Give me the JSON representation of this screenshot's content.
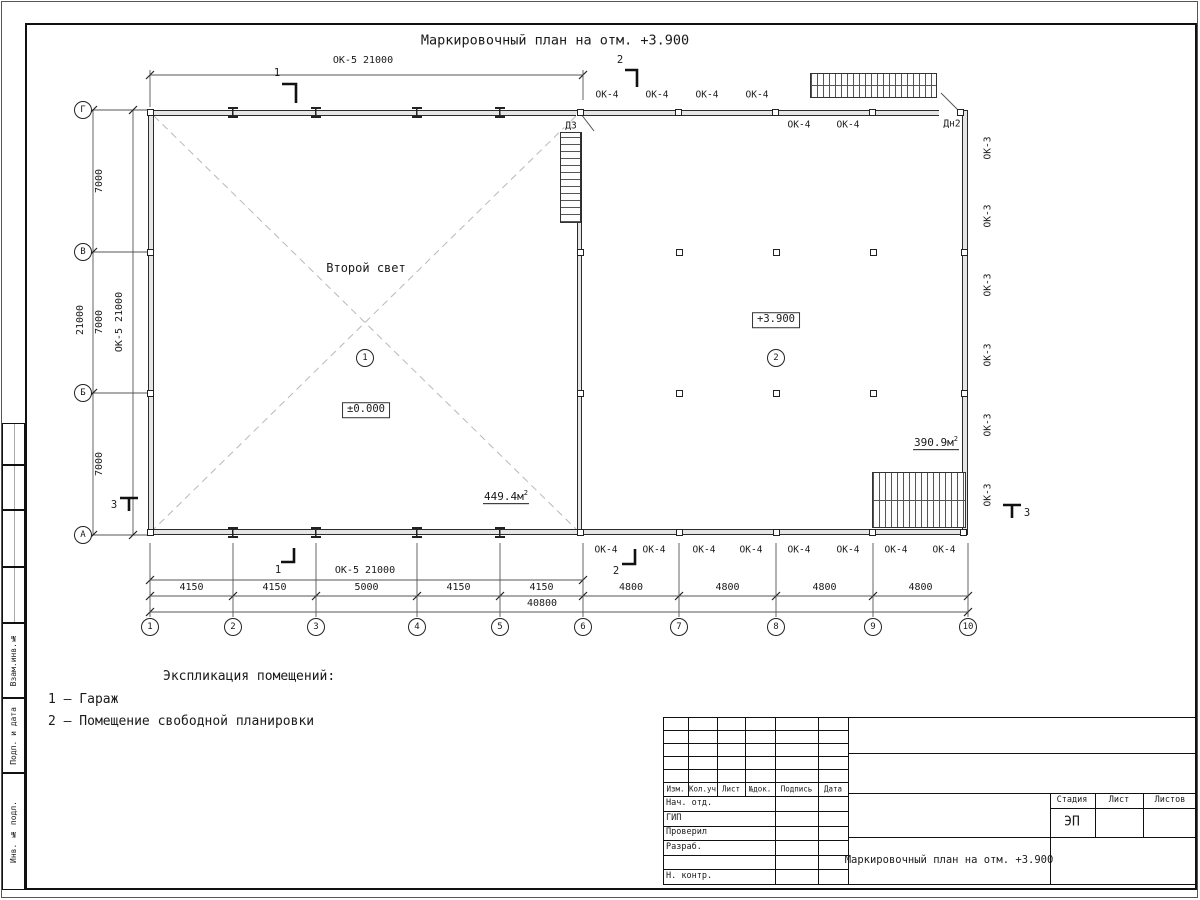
{
  "title": "Маркировочный план на отм. +3.900",
  "axes": {
    "bottom": [
      "1",
      "2",
      "3",
      "4",
      "5",
      "6",
      "7",
      "8",
      "9",
      "10"
    ],
    "left": [
      "Г",
      "В",
      "Б",
      "А"
    ]
  },
  "dims": {
    "top_left_room": "ОК-5 21000",
    "bottom_left_room": "ОК-5 21000",
    "left_inner": "ОК-5 21000",
    "left_segments": [
      "7000",
      "7000",
      "7000"
    ],
    "left_total": "21000",
    "bottom_segments": [
      "4150",
      "4150",
      "5000",
      "4150",
      "4150",
      "4800",
      "4800",
      "4800",
      "4800"
    ],
    "bottom_total": "40800"
  },
  "windows": {
    "ok4_top": [
      "ОК-4",
      "ОК-4",
      "ОК-4",
      "ОК-4"
    ],
    "ok4_inner": [
      "ОК-4",
      "ОК-4"
    ],
    "ok4_bottom": [
      "ОК-4",
      "ОК-4",
      "ОК-4",
      "ОК-4",
      "ОК-4",
      "ОК-4",
      "ОК-4",
      "ОК-4"
    ],
    "ok3_right": [
      "ОК-3",
      "ОК-3",
      "ОК-3",
      "ОК-3",
      "ОК-3",
      "ОК-3"
    ]
  },
  "doors": {
    "d3": "Д3",
    "dn2": "Дн2"
  },
  "sections": {
    "labels": [
      "1",
      "2",
      "3"
    ]
  },
  "rooms": {
    "r1": {
      "label": "Второй свет",
      "num": "1",
      "level": "±0.000",
      "area": "449.4м",
      "area_sup": "2"
    },
    "r2": {
      "num": "2",
      "level": "+3.900",
      "area": "390.9м",
      "area_sup": "2"
    }
  },
  "legend": {
    "heading": "Экспликация помещений:",
    "items": [
      "1 – Гараж",
      "2 – Помещение свободной планировки"
    ]
  },
  "titleblock": {
    "header_cols": [
      "Изм.",
      "Кол.уч",
      "Лист",
      "№док.",
      "Подпись",
      "Дата"
    ],
    "staff_rows": [
      "Нач. отд.",
      "ГИП",
      "Проверил",
      "Разраб.",
      "",
      "Н. контр."
    ],
    "doc_title": "Маркировочный план на отм. +3.900",
    "stage_label": "Стадия",
    "sheet_label": "Лист",
    "sheets_label": "Листов",
    "stage_value": "ЭП"
  },
  "margin_strip": {
    "labels": [
      "Взам.инв.№",
      "Подп. и дата",
      "Инв. № подл."
    ]
  }
}
